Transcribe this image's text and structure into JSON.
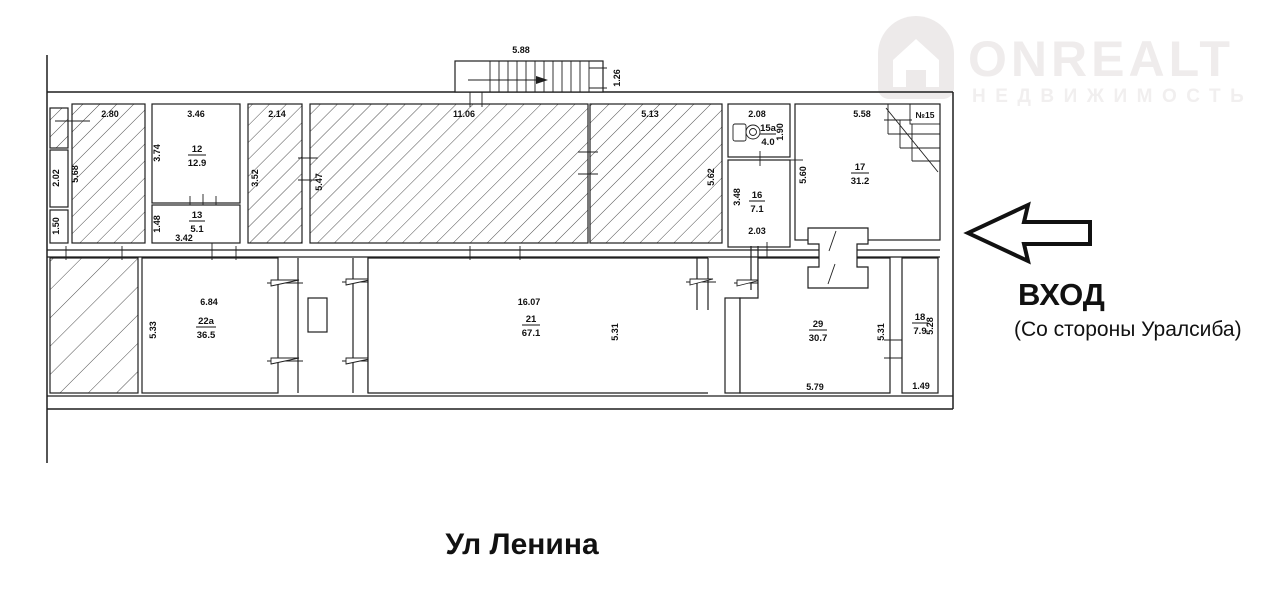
{
  "watermark": {
    "brand": "ONREALT",
    "subtitle": "НЕДВИЖИМОСТЬ"
  },
  "entrance": {
    "title": "ВХОД",
    "subtitle": "(Со стороны Уралсиба)"
  },
  "street_label": "Ул Ленина",
  "plan": {
    "stairs": {
      "width": "5.88",
      "depth": "1.26"
    },
    "strip": {
      "upper": "2.02",
      "lower": "1.50"
    },
    "hatched_a": {
      "w": "2.80",
      "h": "5.68"
    },
    "hatched_b": {
      "w": "2.14",
      "h": "3.52"
    },
    "hatched_c": {
      "w": "11.06",
      "h": "5.47"
    },
    "hatched_d": {
      "w": "5.13",
      "h": "5.62"
    },
    "rooms": {
      "r12": {
        "no": "12",
        "area": "12.9",
        "w": "3.46",
        "h": "3.74"
      },
      "r13": {
        "no": "13",
        "area": "5.1",
        "w": "3.42",
        "h": "1.48"
      },
      "r15a": {
        "no": "15а",
        "area": "4.0",
        "w": "2.08",
        "h": "1.90"
      },
      "r16": {
        "no": "16",
        "area": "7.1",
        "h": "3.48",
        "b": "2.03"
      },
      "r17": {
        "no": "17",
        "area": "31.2",
        "w": "5.58",
        "h": "5.60",
        "unit": "№15"
      },
      "r22a": {
        "no": "22а",
        "area": "36.5",
        "w": "6.84",
        "h": "5.33"
      },
      "r21": {
        "no": "21",
        "area": "67.1",
        "w": "16.07",
        "h": "5.31"
      },
      "r29": {
        "no": "29",
        "area": "30.7",
        "h": "5.31",
        "b": "5.79"
      },
      "r18": {
        "no": "18",
        "area": "7.9",
        "h": "5.28",
        "b": "1.49"
      }
    }
  }
}
